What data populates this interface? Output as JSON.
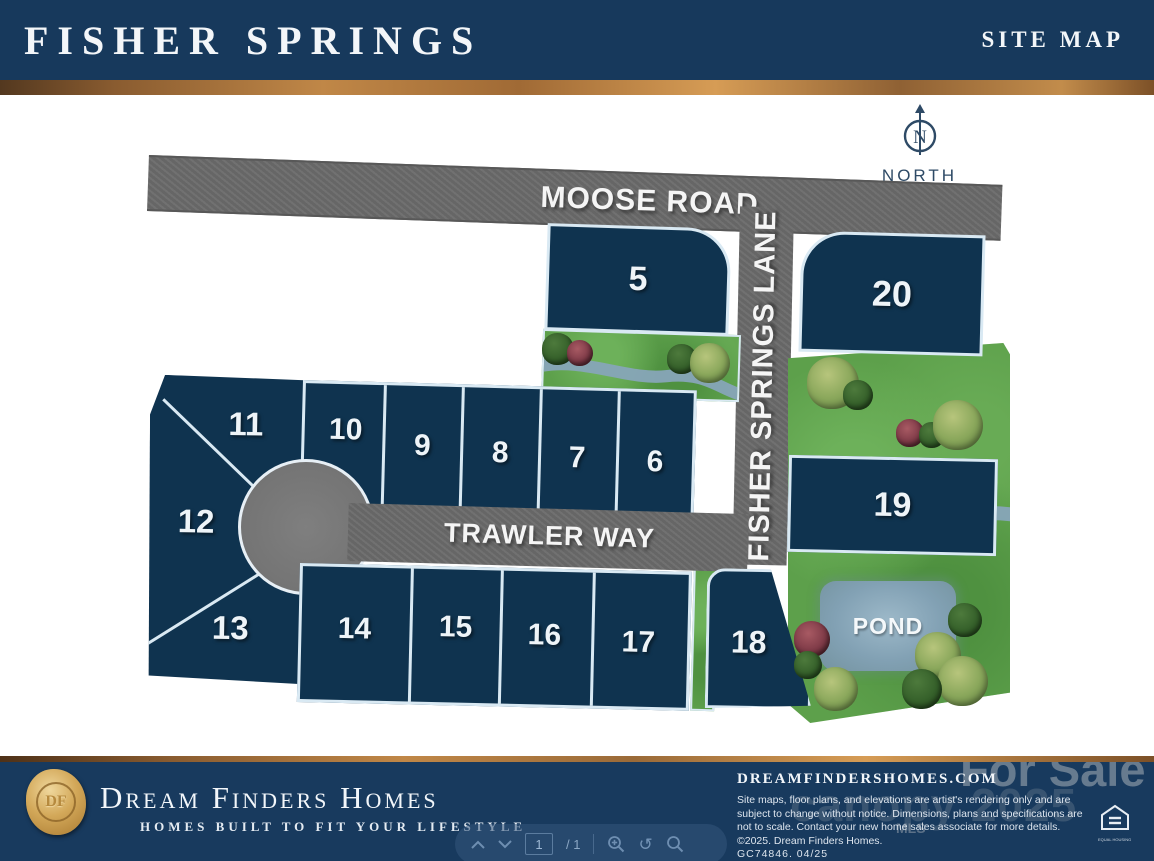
{
  "header": {
    "title": "FISHER SPRINGS",
    "subtitle": "SITE MAP"
  },
  "map": {
    "north_label": "NORTH",
    "north_letter": "N",
    "roads": {
      "moose": "MOOSE ROAD",
      "fisher": "FISHER SPRINGS LANE",
      "trawler": "TRAWLER WAY"
    },
    "pond_label": "POND",
    "lots": [
      "5",
      "6",
      "7",
      "8",
      "9",
      "10",
      "11",
      "12",
      "13",
      "14",
      "15",
      "16",
      "17",
      "18",
      "19",
      "20"
    ]
  },
  "footer": {
    "logo_monogram": "DF",
    "brand": "Dream Finders Homes",
    "tagline": "HOMES BUILT TO FIT YOUR LIFESTYLE",
    "website": "DREAMFINDERSHOMES.COM",
    "disclaimer": "Site maps, floor plans, and elevations are artist's rendering only and are subject to change without notice. Dimensions, plans and specifications are not to scale. Contact your new home sales associate for more details. ©2025. Dream Finders Homes.",
    "license": "GC74846.   04/25",
    "watermark_for_sale": "For Sale",
    "watermark_canopy": "canopy 2025",
    "watermark_mls": "MLS",
    "eho_caption": "EQUAL HOUSING"
  },
  "toolbar": {
    "page_value": "1",
    "page_total": "/ 1"
  },
  "colors": {
    "navy_header": "#17395c",
    "navy_lot": "#0f334f",
    "gold": "#c08747",
    "road_gray": "#6b6b6b",
    "green": "#5da04b",
    "stream": "#87a5b8",
    "pond": "#82a1b4",
    "lot_border": "#d9e9f3"
  }
}
